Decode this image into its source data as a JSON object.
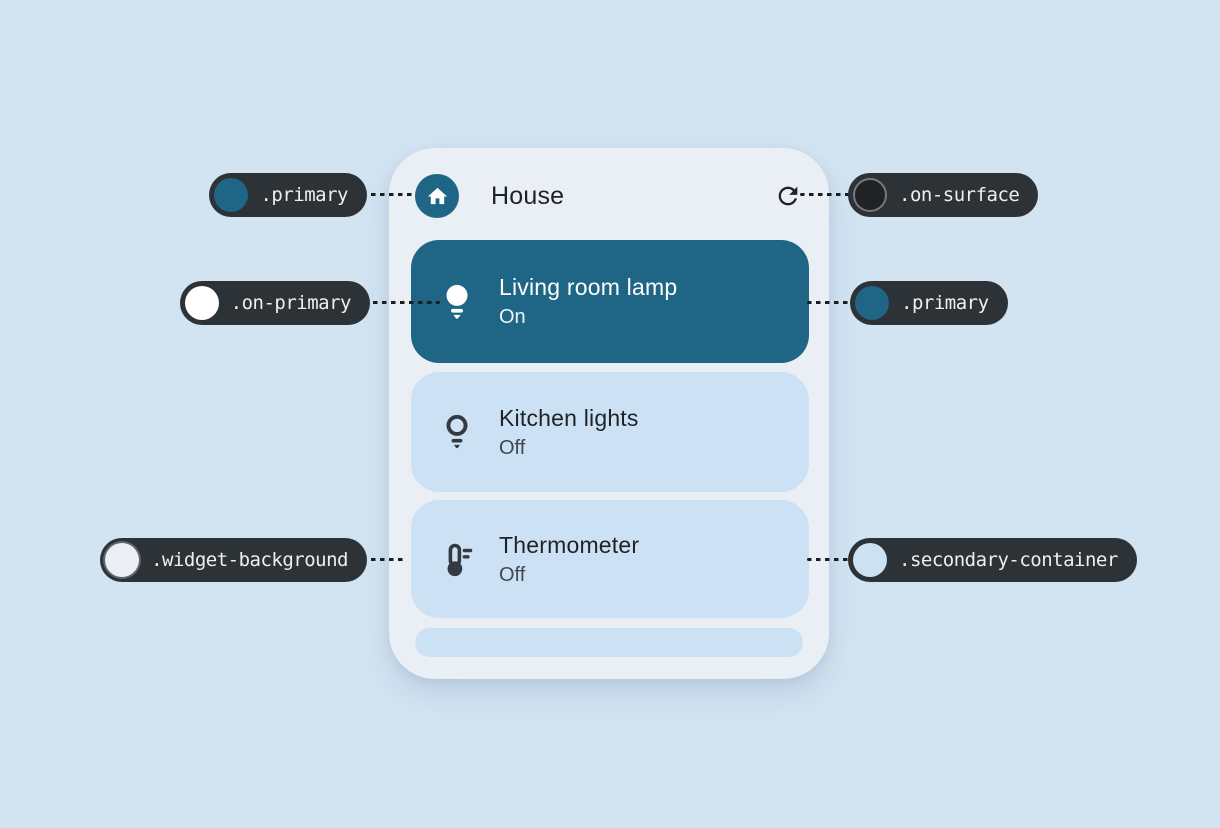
{
  "colors": {
    "page_background": "#d2e3f2",
    "widget_background": "#eaeff5",
    "primary": "#1f6585",
    "secondary_container": "#cde1f4",
    "on_primary": "#ffffff",
    "on_surface": "#1f2326",
    "annotation_pill_background": "#2d3236",
    "annotation_text": "#edeff0",
    "dark_icon": "#333a41"
  },
  "widget": {
    "header": {
      "title": "House",
      "app_icon": "home-icon",
      "action_icon": "refresh-icon"
    },
    "tiles": [
      {
        "name": "Living room lamp",
        "status": "On",
        "icon": "lightbulb-filled-icon",
        "background": "#1f6585"
      },
      {
        "name": "Kitchen lights",
        "status": "Off",
        "icon": "lightbulb-outline-icon",
        "background": "#cde1f4"
      },
      {
        "name": "Thermometer",
        "status": "Off",
        "icon": "thermometer-icon",
        "background": "#cde1f4"
      }
    ],
    "partial_tile_background": "#cde1f4"
  },
  "annotations": {
    "items": [
      {
        "token": ".primary",
        "swatch": "#1f6585",
        "side": "left",
        "target": "house-app-icon"
      },
      {
        "token": ".on-surface",
        "swatch": "#1f2326",
        "side": "right",
        "target": "refresh-icon"
      },
      {
        "token": ".on-primary",
        "swatch": "#ffffff",
        "side": "left",
        "target": "lamp-icon"
      },
      {
        "token": ".primary",
        "swatch": "#1f6585",
        "side": "right",
        "target": "living-room-lamp-tile"
      },
      {
        "token": ".widget-background",
        "swatch": "#eaeff5",
        "side": "left",
        "target": "widget-surface"
      },
      {
        "token": ".secondary-container",
        "swatch": "#cde1f4",
        "side": "right",
        "target": "thermometer-tile"
      }
    ]
  }
}
